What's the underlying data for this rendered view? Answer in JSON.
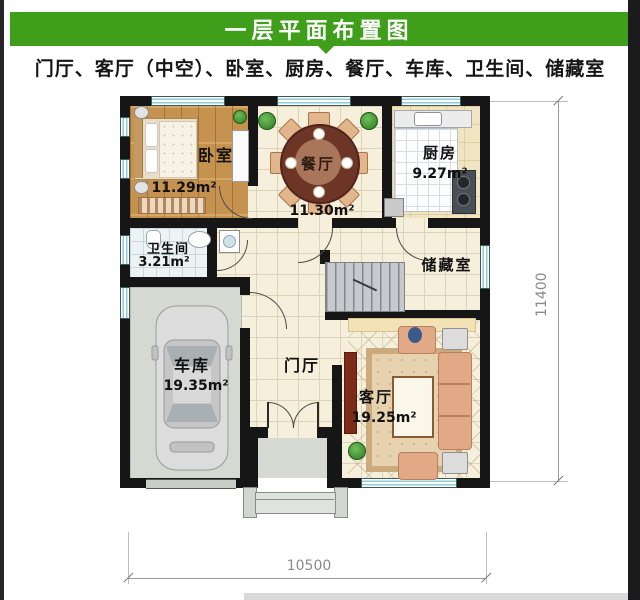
{
  "header": {
    "title": "一层平面布置图"
  },
  "subtitle": {
    "text": "门厅、客厅（中空）、卧室、厨房、餐厅、车库、卫生间、储藏室"
  },
  "plan": {
    "rooms": {
      "bedroom": {
        "name": "卧室",
        "area": "11.29m²"
      },
      "dining": {
        "name": "餐厅",
        "area": "11.30m²"
      },
      "kitchen": {
        "name": "厨房",
        "area": "9.27m²"
      },
      "bathroom": {
        "name": "卫生间",
        "area": "3.21m²"
      },
      "storage": {
        "name": "储藏室"
      },
      "garage": {
        "name": "车库",
        "area": "19.35m²"
      },
      "foyer": {
        "name": "门厅"
      },
      "living": {
        "name": "客厅",
        "area": "19.25m²"
      }
    },
    "dimensions": {
      "width": "10500",
      "height": "11400"
    }
  },
  "colors": {
    "accent_green": "#3f9e1a",
    "wall_black": "#161616",
    "window_teal": "#8fcdd4",
    "wood_floor": "#c6924f",
    "tile_cream": "#f6efdc"
  }
}
